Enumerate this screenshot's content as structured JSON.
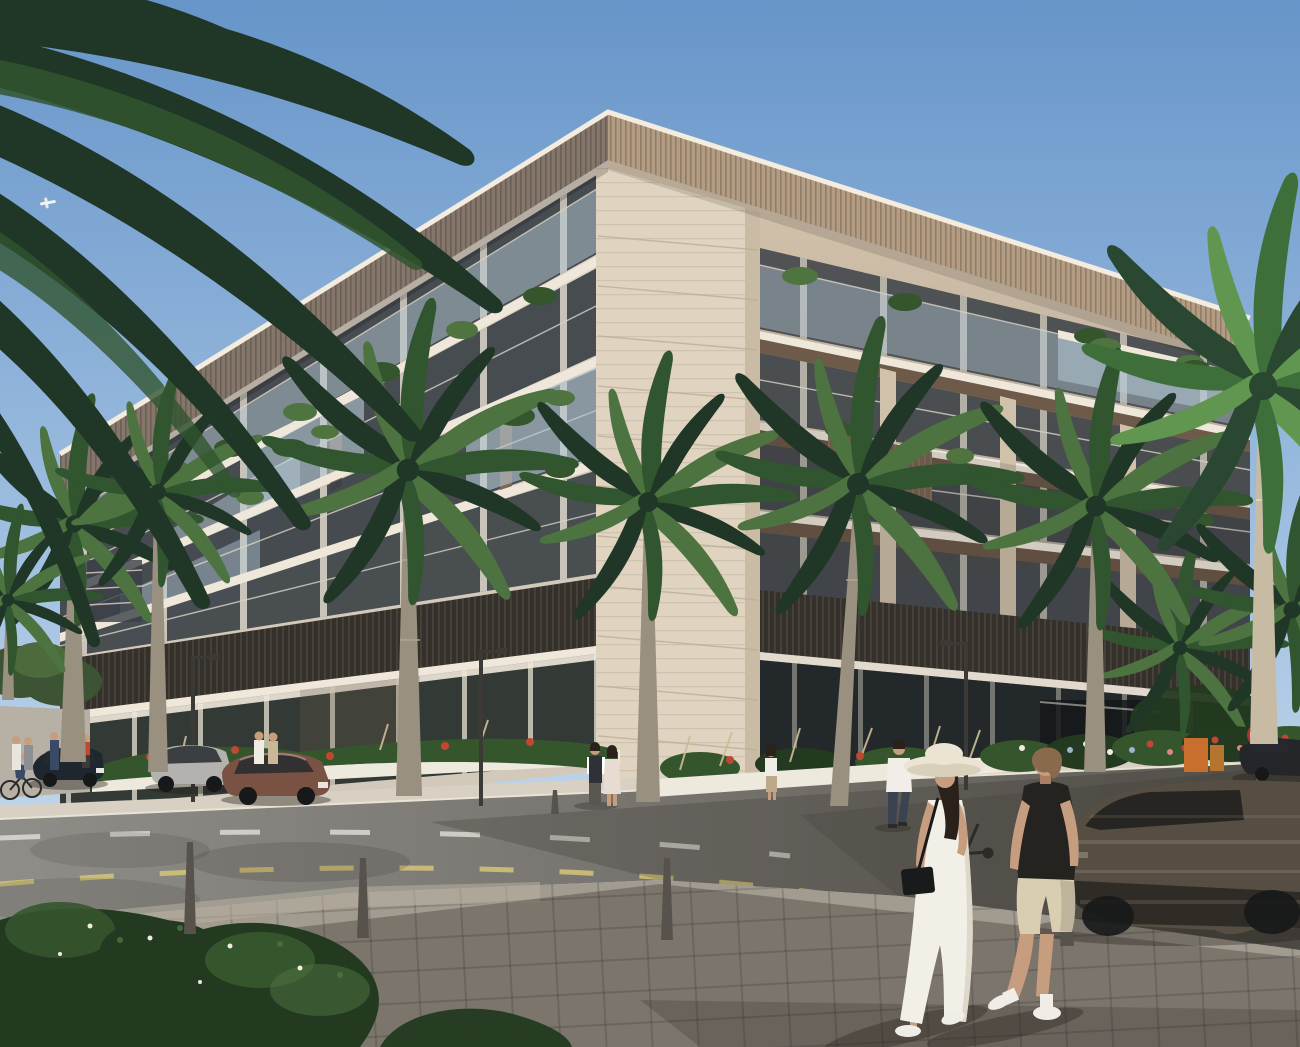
{
  "scene": {
    "type": "architectural-exterior-render",
    "description": "Corner view of a modern 6-storey cream apartment building with louvered roof cornice, plant-filled balconies, dark slatted band above glass storefronts, palm-lined street, parked cars, a motion-blurred passing car and a couple crossing the road in the foreground",
    "time_of_day": "late afternoon sunshine",
    "building_floors": 6,
    "palm_count": 9,
    "parked_cars": [
      "dark navy sedan",
      "silver suv",
      "bronze sedan",
      "black car right"
    ],
    "moving_cars": 1,
    "foreground_people": [
      "woman in white dress with sun hat and black crossbody bag",
      "man in black polo and khaki shorts"
    ],
    "signs": [
      "no-entry sign"
    ],
    "road_markings": [
      "yellow dashed edge line",
      "white dashed lane line",
      "white stop line"
    ]
  },
  "palette": {
    "sky_top": "#6795c9",
    "sky_mid": "#a3c2e2",
    "sky_low": "#d8e5f1",
    "fascia_shade": "#84766a",
    "fascia_sun": "#b49c82",
    "fascia_cap": "#f3ecdf",
    "fascia_under": "#55493e",
    "wall_left": "#ded5c6",
    "wall_left_low": "#c9bfb1",
    "wall_right_sun": "#d0c1ab",
    "wall_right_low": "#9d958e",
    "pier": "#e0d4c0",
    "pier_shade": "#c9bba4",
    "pier_line": "#bfae95",
    "glass": "#57606a",
    "glass_dark": "#3a4046",
    "frame_light": "#efe8da",
    "balc_glass": "#b5c9d6",
    "rail_light": "#d9d3c6",
    "soffit": "#6e5a49",
    "fin_brown": "#7d6654",
    "louver": "#35302a",
    "louver_line": "#514941",
    "store_glass": "#333a35",
    "store_glass_r": "#23282a",
    "mullion": "#cfc5b1",
    "planter_white": "#eee9dd",
    "walkway": "#d8d0c2",
    "curb": "#e9e3d6",
    "road": "#8f8d88",
    "road_dark": "#5e5a54",
    "sidewalk": "#a29b90",
    "paver_line": "#6f695f",
    "sun_patch": "#b8b0a1",
    "shadow": "#241f19",
    "bush_dark": "#233a20",
    "bush_mid": "#35552d",
    "bush_light": "#507440",
    "grass_tan": "#cdbd98",
    "palm_dark": "#203626",
    "palm_mid": "#31552f",
    "palm_light": "#4c7340",
    "trunk": "#99907f",
    "trunk_dark": "#6e665a",
    "crownshaft": "#69744a",
    "flower_red": "#c24733",
    "flower_pink": "#d98a7d",
    "flower_white": "#f1ecdf",
    "flower_blue": "#9fb3cc",
    "lamp_metal": "#3b3a37",
    "bollard": "#57534c",
    "car_navy": "#1e2630",
    "car_silver": "#b3b2ae",
    "car_bronze": "#7a5243",
    "car_glass": "#262a2e",
    "car_dark": "#24262a",
    "blur_car": "#564e42",
    "blur_car_low": "#2b2823",
    "wheel": "#17181a",
    "sign_red": "#b03427",
    "sign_white": "#f0ede6",
    "orange_box": "#c96f2e",
    "skin": "#c79d7f",
    "skin_shade": "#a87f63",
    "dress_white": "#f2efe7",
    "dress_shade": "#d8d2c4",
    "hat": "#ece4d2",
    "bag_black": "#181a1c",
    "hair_dark": "#2a211b",
    "hair_brown": "#8a6a4c",
    "shirt_black": "#242320",
    "shorts_khaki": "#d9cdb2",
    "shoe_white": "#f0ede7",
    "shirt_white": "#f1eee8",
    "jeans": "#3a4350",
    "vest_dark": "#2e3236",
    "dress_floral": "#e7dbd2",
    "plane_white": "#f4f2ee",
    "mark_yellow": "#d4c678",
    "mark_white": "#e8e6de"
  }
}
